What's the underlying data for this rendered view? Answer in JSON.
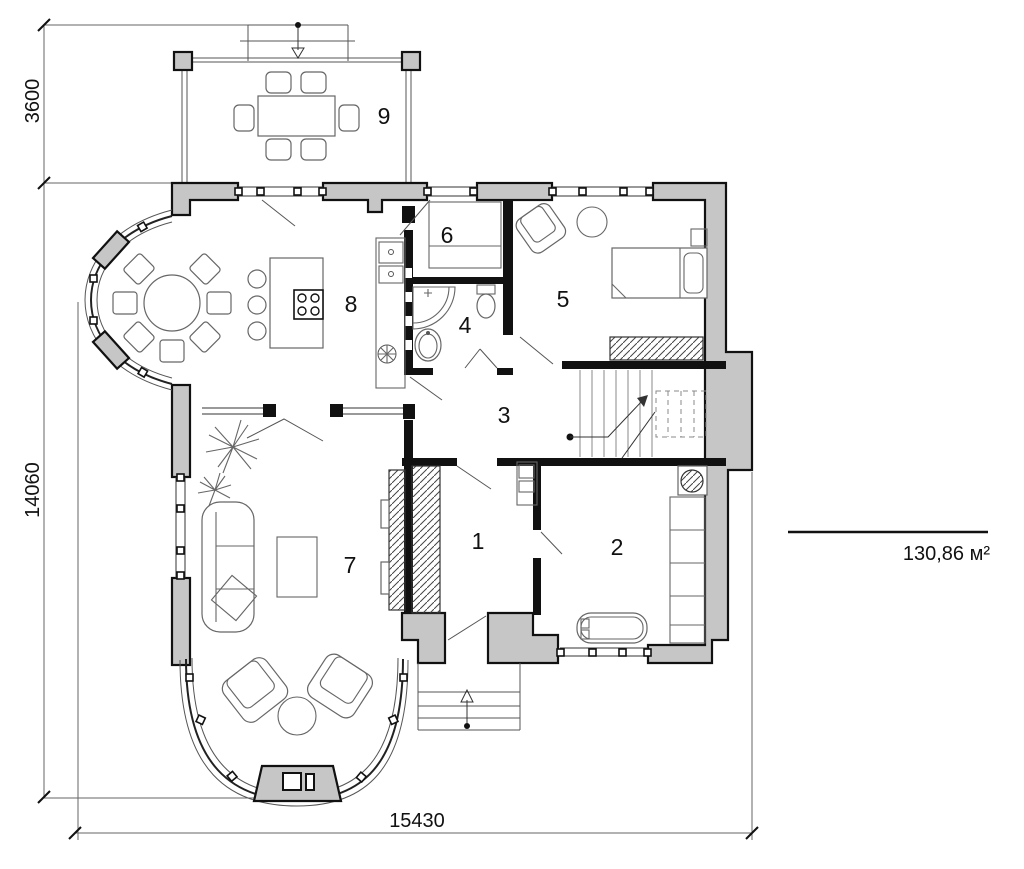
{
  "plan": {
    "room_labels": {
      "r1": "1",
      "r2": "2",
      "r3": "3",
      "r4": "4",
      "r5": "5",
      "r6": "6",
      "r7": "7",
      "r8": "8",
      "r9": "9"
    },
    "dimensions": {
      "left_top": "3600",
      "left_main": "14060",
      "bottom": "15430"
    },
    "area_label": "130,86 м²",
    "colors": {
      "wall_fill": "#c6c6c6",
      "wall_stroke": "#111111",
      "thin_line": "#555555",
      "background": "#ffffff"
    }
  }
}
